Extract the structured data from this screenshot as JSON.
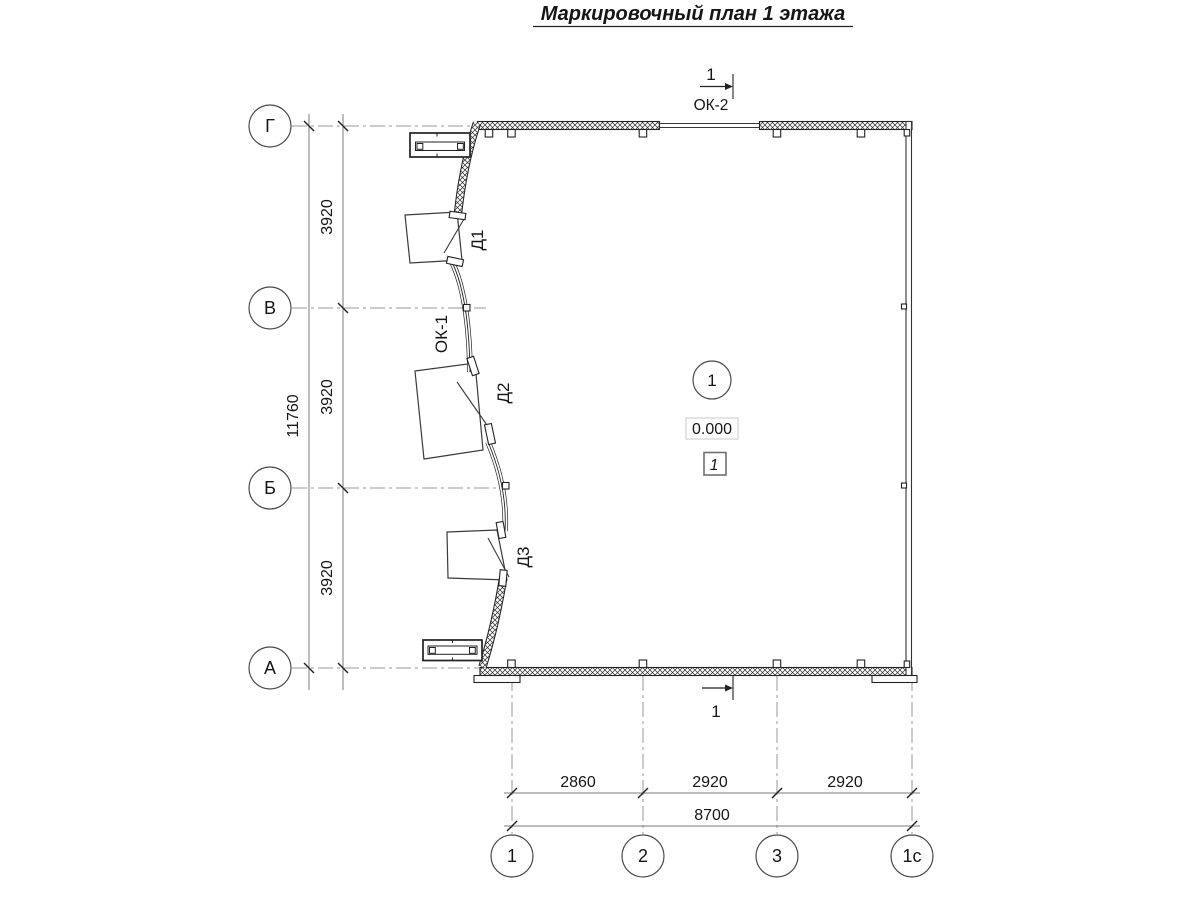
{
  "title": "Маркировочный план 1 этажа",
  "colors": {
    "line": "#222222",
    "axis": "#9a9a9a",
    "dim": "#7b7b7b",
    "background": "#ffffff"
  },
  "axes": {
    "rows": [
      {
        "label": "Г"
      },
      {
        "label": "В"
      },
      {
        "label": "Б"
      },
      {
        "label": "А"
      }
    ],
    "cols": [
      {
        "label": "1"
      },
      {
        "label": "2"
      },
      {
        "label": "3"
      },
      {
        "label": "1с"
      }
    ]
  },
  "dimensions": {
    "left": {
      "segments": [
        "3920",
        "3920",
        "3920"
      ],
      "total": "11760"
    },
    "bottom": {
      "segments": [
        "2860",
        "2920",
        "2920"
      ],
      "total": "8700"
    }
  },
  "labels": {
    "doors": [
      {
        "text": "Д1"
      },
      {
        "text": "Д2"
      },
      {
        "text": "Д3"
      }
    ],
    "window": "ОК-1",
    "window_top": "ОК-2"
  },
  "section": {
    "top": "1",
    "bottom": "1"
  },
  "room": {
    "number": "1",
    "level": "0.000",
    "type": "1"
  }
}
